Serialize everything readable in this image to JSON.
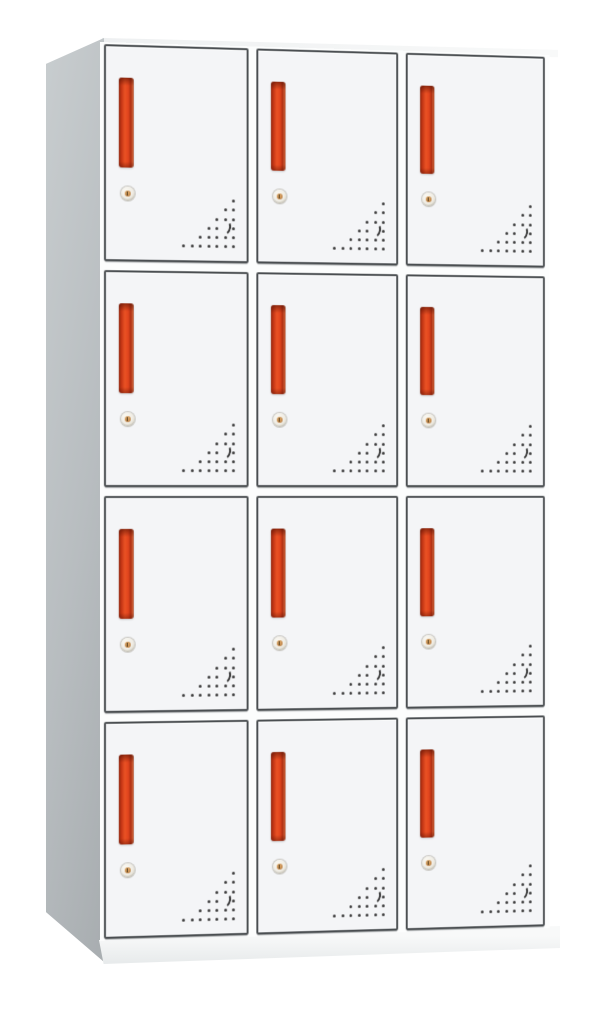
{
  "product": {
    "subject": "12-door steel locker cabinet, white with grey side panel",
    "view": "front three-quarter product photo on white background"
  },
  "cabinet": {
    "rows": 4,
    "columns": 3,
    "door_count": 12,
    "door_features": [
      "red-vertical-handle",
      "round-cam-lock",
      "triangular-vent-holes"
    ],
    "colors": {
      "side_panel": "#b8bdc0",
      "side_panel_light": "#c8cdcf",
      "side_panel_dark": "#a9aeb1",
      "front_frame": "#fcfdfd",
      "door_fill": "#f4f5f7",
      "door_border": "#4a4e51",
      "handle_red": "#e2451e",
      "handle_red_bright": "#ea5224",
      "handle_red_dark": "#922810",
      "lock_face": "#efece4",
      "lock_core": "#c08447",
      "vent_dot": "#3b3b3b",
      "base": "#f8f9f9",
      "base_shadow": "#e7eaeb"
    },
    "vent_pattern": {
      "dots": [
        [
          51,
          0
        ],
        [
          43,
          9
        ],
        [
          51,
          9
        ],
        [
          34,
          19
        ],
        [
          43,
          19
        ],
        [
          51,
          19
        ],
        [
          26,
          28
        ],
        [
          34,
          28
        ],
        [
          51,
          28
        ],
        [
          17,
          37
        ],
        [
          26,
          37
        ],
        [
          34,
          37
        ],
        [
          43,
          37
        ],
        [
          51,
          37
        ],
        [
          0,
          46
        ],
        [
          9,
          46
        ],
        [
          17,
          46
        ],
        [
          26,
          46
        ],
        [
          34,
          46
        ],
        [
          43,
          46
        ],
        [
          51,
          46
        ]
      ],
      "crescent": {
        "x": 39,
        "y": 21
      }
    }
  }
}
